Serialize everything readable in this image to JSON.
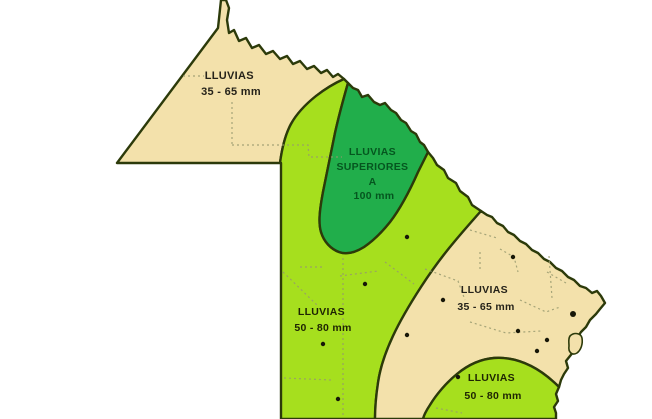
{
  "map": {
    "background_color": "#FFFFFF",
    "outline_color": "#2C3A0A",
    "legend_colors": {
      "rain_35_65_mm": "#F3E1AB",
      "rain_50_80_mm": "#A6DF1E",
      "rain_over_100_mm": "#21AE4B"
    },
    "label_colors": {
      "on_tan": "#26231A",
      "on_light_green": "#1E2403",
      "on_dark_green": "#05561F"
    },
    "regions": {
      "northwest": {
        "line1": "LLUVIAS",
        "line2": "35 - 65 mm"
      },
      "north_center": {
        "line1": "LLUVIAS",
        "line2": "SUPERIORES",
        "line3": "A",
        "line4": "100 mm"
      },
      "center": {
        "line1": "LLUVIAS",
        "line2": "50 - 80 mm"
      },
      "east": {
        "line1": "LLUVIAS",
        "line2": "35 - 65 mm"
      },
      "southeast": {
        "line1": "LLUVIAS",
        "line2": "50 - 80 mm"
      }
    }
  }
}
